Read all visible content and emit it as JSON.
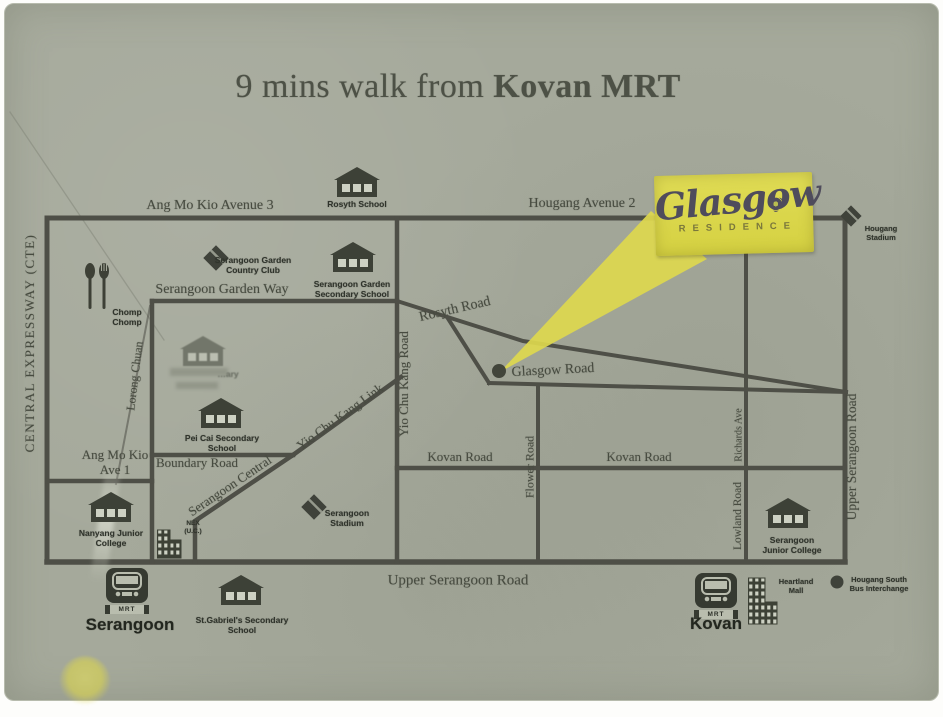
{
  "title": {
    "prefix": "9 mins walk from ",
    "highlight": "Kovan MRT"
  },
  "logo": {
    "name": "Glasgow",
    "subtitle": "RESIDENCE"
  },
  "mrt": {
    "label": "MRT",
    "serangoon": "Serangoon",
    "kovan": "Kovan"
  },
  "roads": {
    "ang_mo_kio_avenue_3": "Ang Mo Kio Avenue 3",
    "hougang_avenue_2": "Hougang Avenue 2",
    "serangoon_garden_way": "Serangoon Garden Way",
    "rosyth_road": "Rosyth Road",
    "glasgow_road": "Glasgow Road",
    "yio_chu_kang_road": "Yio Chu Kang Road",
    "yio_chu_kang_link": "Yio Chu Kang Link",
    "serangoon_central": "Serangoon Central",
    "boundary_road": "Boundary Road",
    "kovan_road_west": "Kovan Road",
    "kovan_road_east": "Kovan Road",
    "flower_road": "Flower Road",
    "richards_ave": "Richards Ave",
    "lowland_road": "Lowland Road",
    "upper_serangoon_road_bottom": "Upper Serangoon Road",
    "upper_serangoon_road_right": "Upper Serangoon Road",
    "central_expressway": "CENTRAL EXPRESSWAY (CTE)",
    "lorong_chuan": "Lorong Chuan",
    "ang_mo_kio_ave_1": "Ang Mo Kio Ave 1"
  },
  "pois": {
    "rosyth_school": "Rosyth School",
    "serangoon_garden_country_club": "Serangoon Garden Country Club",
    "serangoon_garden_secondary_school": "Serangoon Garden Secondary School",
    "chomp_chomp": "Chomp Chomp",
    "faded_school": "…ary",
    "pei_cai_secondary_school": "Pei Cai Secondary School",
    "serangoon_stadium": "Serangoon Stadium",
    "nanyang_junior_college": "Nanyang Junior College",
    "nex": "NEX (U.C.)",
    "st_gabriels_secondary_school": "St.Gabriel's Secondary School",
    "serangoon_junior_college": "Serangoon Junior College",
    "heartland_mall": "Heartland Mall",
    "hougang_south_bus_interchange": "Hougang South Bus Interchange",
    "hougang_stadium": "Hougang Stadium"
  },
  "colors": {
    "paper": "#a5a99b",
    "road": "#4e4f47",
    "accent_yellow": "#dcd84d",
    "serif_text": "#474b40",
    "logo_text": "#4f4c5c"
  }
}
